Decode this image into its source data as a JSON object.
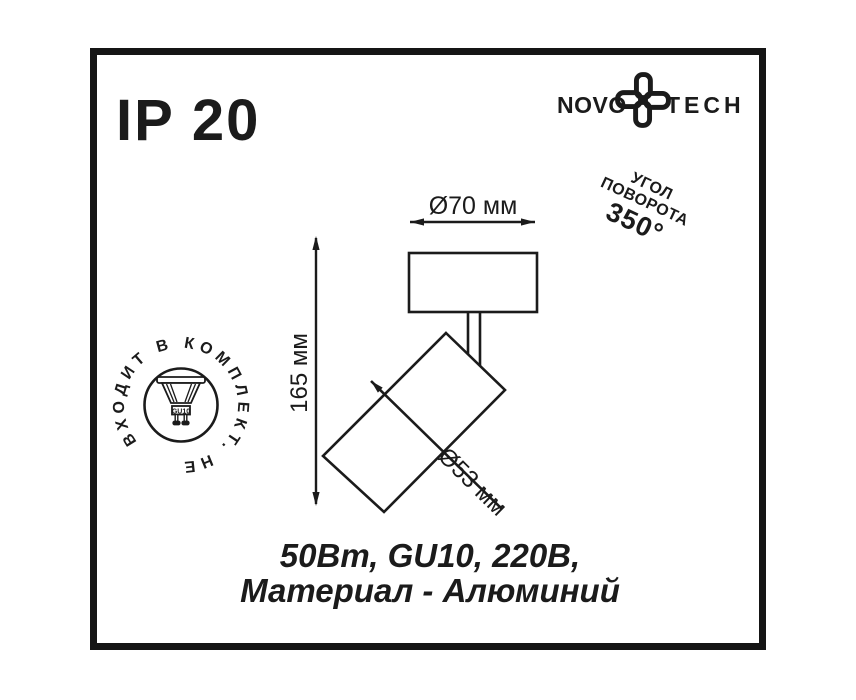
{
  "ip_rating": "IP 20",
  "logo": {
    "word_left": "NOVO",
    "word_right": "TECH",
    "icon": "novotech-flower-icon"
  },
  "rotation_note": {
    "line1": "УГОЛ",
    "line2": "ПОВОРОТА",
    "line3": "350°"
  },
  "stamp": {
    "circular_text": "ВХОДИТ В КОМПЛЕКТ. НЕ",
    "meaning": "НЕ ВХОДИТ В КОМПЛЕКТ",
    "lamp_label": "GU10"
  },
  "dimensions": {
    "top_diameter": "Ø70 мм",
    "height": "165 мм",
    "body_diameter": "Ø53 мм"
  },
  "specs": {
    "line1": "50Вт, GU10, 220В,",
    "line2": "Материал - Алюминий"
  },
  "colors": {
    "ink": "#1b1b1b",
    "background": "#ffffff"
  }
}
